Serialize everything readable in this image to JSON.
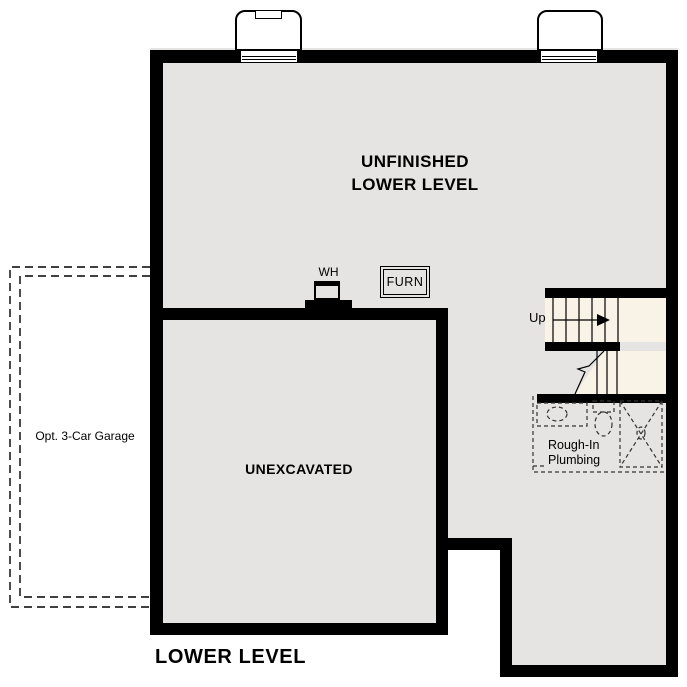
{
  "colors": {
    "floor": "#e5e4e2",
    "stair_floor": "#f8f2e7",
    "wall": "#000000"
  },
  "plan_title": "LOWER LEVEL",
  "rooms": {
    "main": {
      "label_line1": "UNFINISHED",
      "label_line2": "LOWER LEVEL"
    },
    "unexcavated": {
      "label": "UNEXCAVATED"
    },
    "garage": {
      "label": "Opt. 3-Car Garage"
    }
  },
  "fixtures": {
    "water_heater": {
      "label": "WH"
    },
    "furnace": {
      "label": "FURN"
    },
    "stairs": {
      "direction_label": "Up"
    },
    "plumbing": {
      "label_line1": "Rough-In",
      "label_line2": "Plumbing"
    }
  }
}
